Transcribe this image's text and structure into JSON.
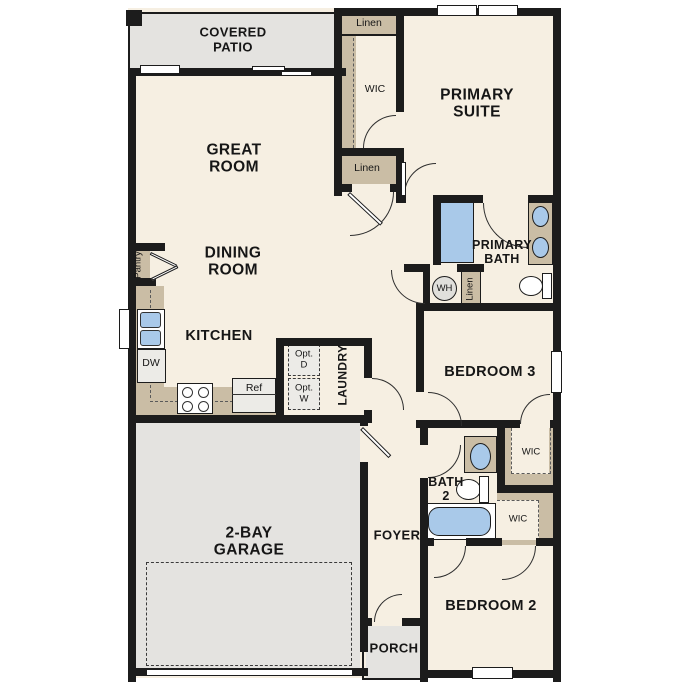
{
  "labels": {
    "covered_patio": "COVERED\nPATIO",
    "great_room": "GREAT\nROOM",
    "dining_room": "DINING\nROOM",
    "kitchen": "KITCHEN",
    "pantry": "Pantry",
    "linen": "Linen",
    "wic": "WIC",
    "primary_suite": "PRIMARY\nSUITE",
    "primary_bath": "PRIMARY\nBATH",
    "wh": "WH",
    "bedroom3": "BEDROOM 3",
    "bedroom2": "BEDROOM 2",
    "bath2": "BATH\n2",
    "laundry": "LAUNDRY",
    "opt_d": "Opt.\nD",
    "opt_w": "Opt.\nW",
    "ref": "Ref",
    "dw": "DW",
    "garage": "2-BAY\nGARAGE",
    "foyer": "FOYER",
    "porch": "PORCH"
  },
  "colors": {
    "wall": "#1c1c1c",
    "room": "#f6efe2",
    "outdoor": "#e4e3e0",
    "closet": "#cabda5",
    "fixture": "#a9c9e9",
    "appliance": "#ecebe7",
    "arc": "#2e2e2e",
    "ink": "#161616"
  }
}
